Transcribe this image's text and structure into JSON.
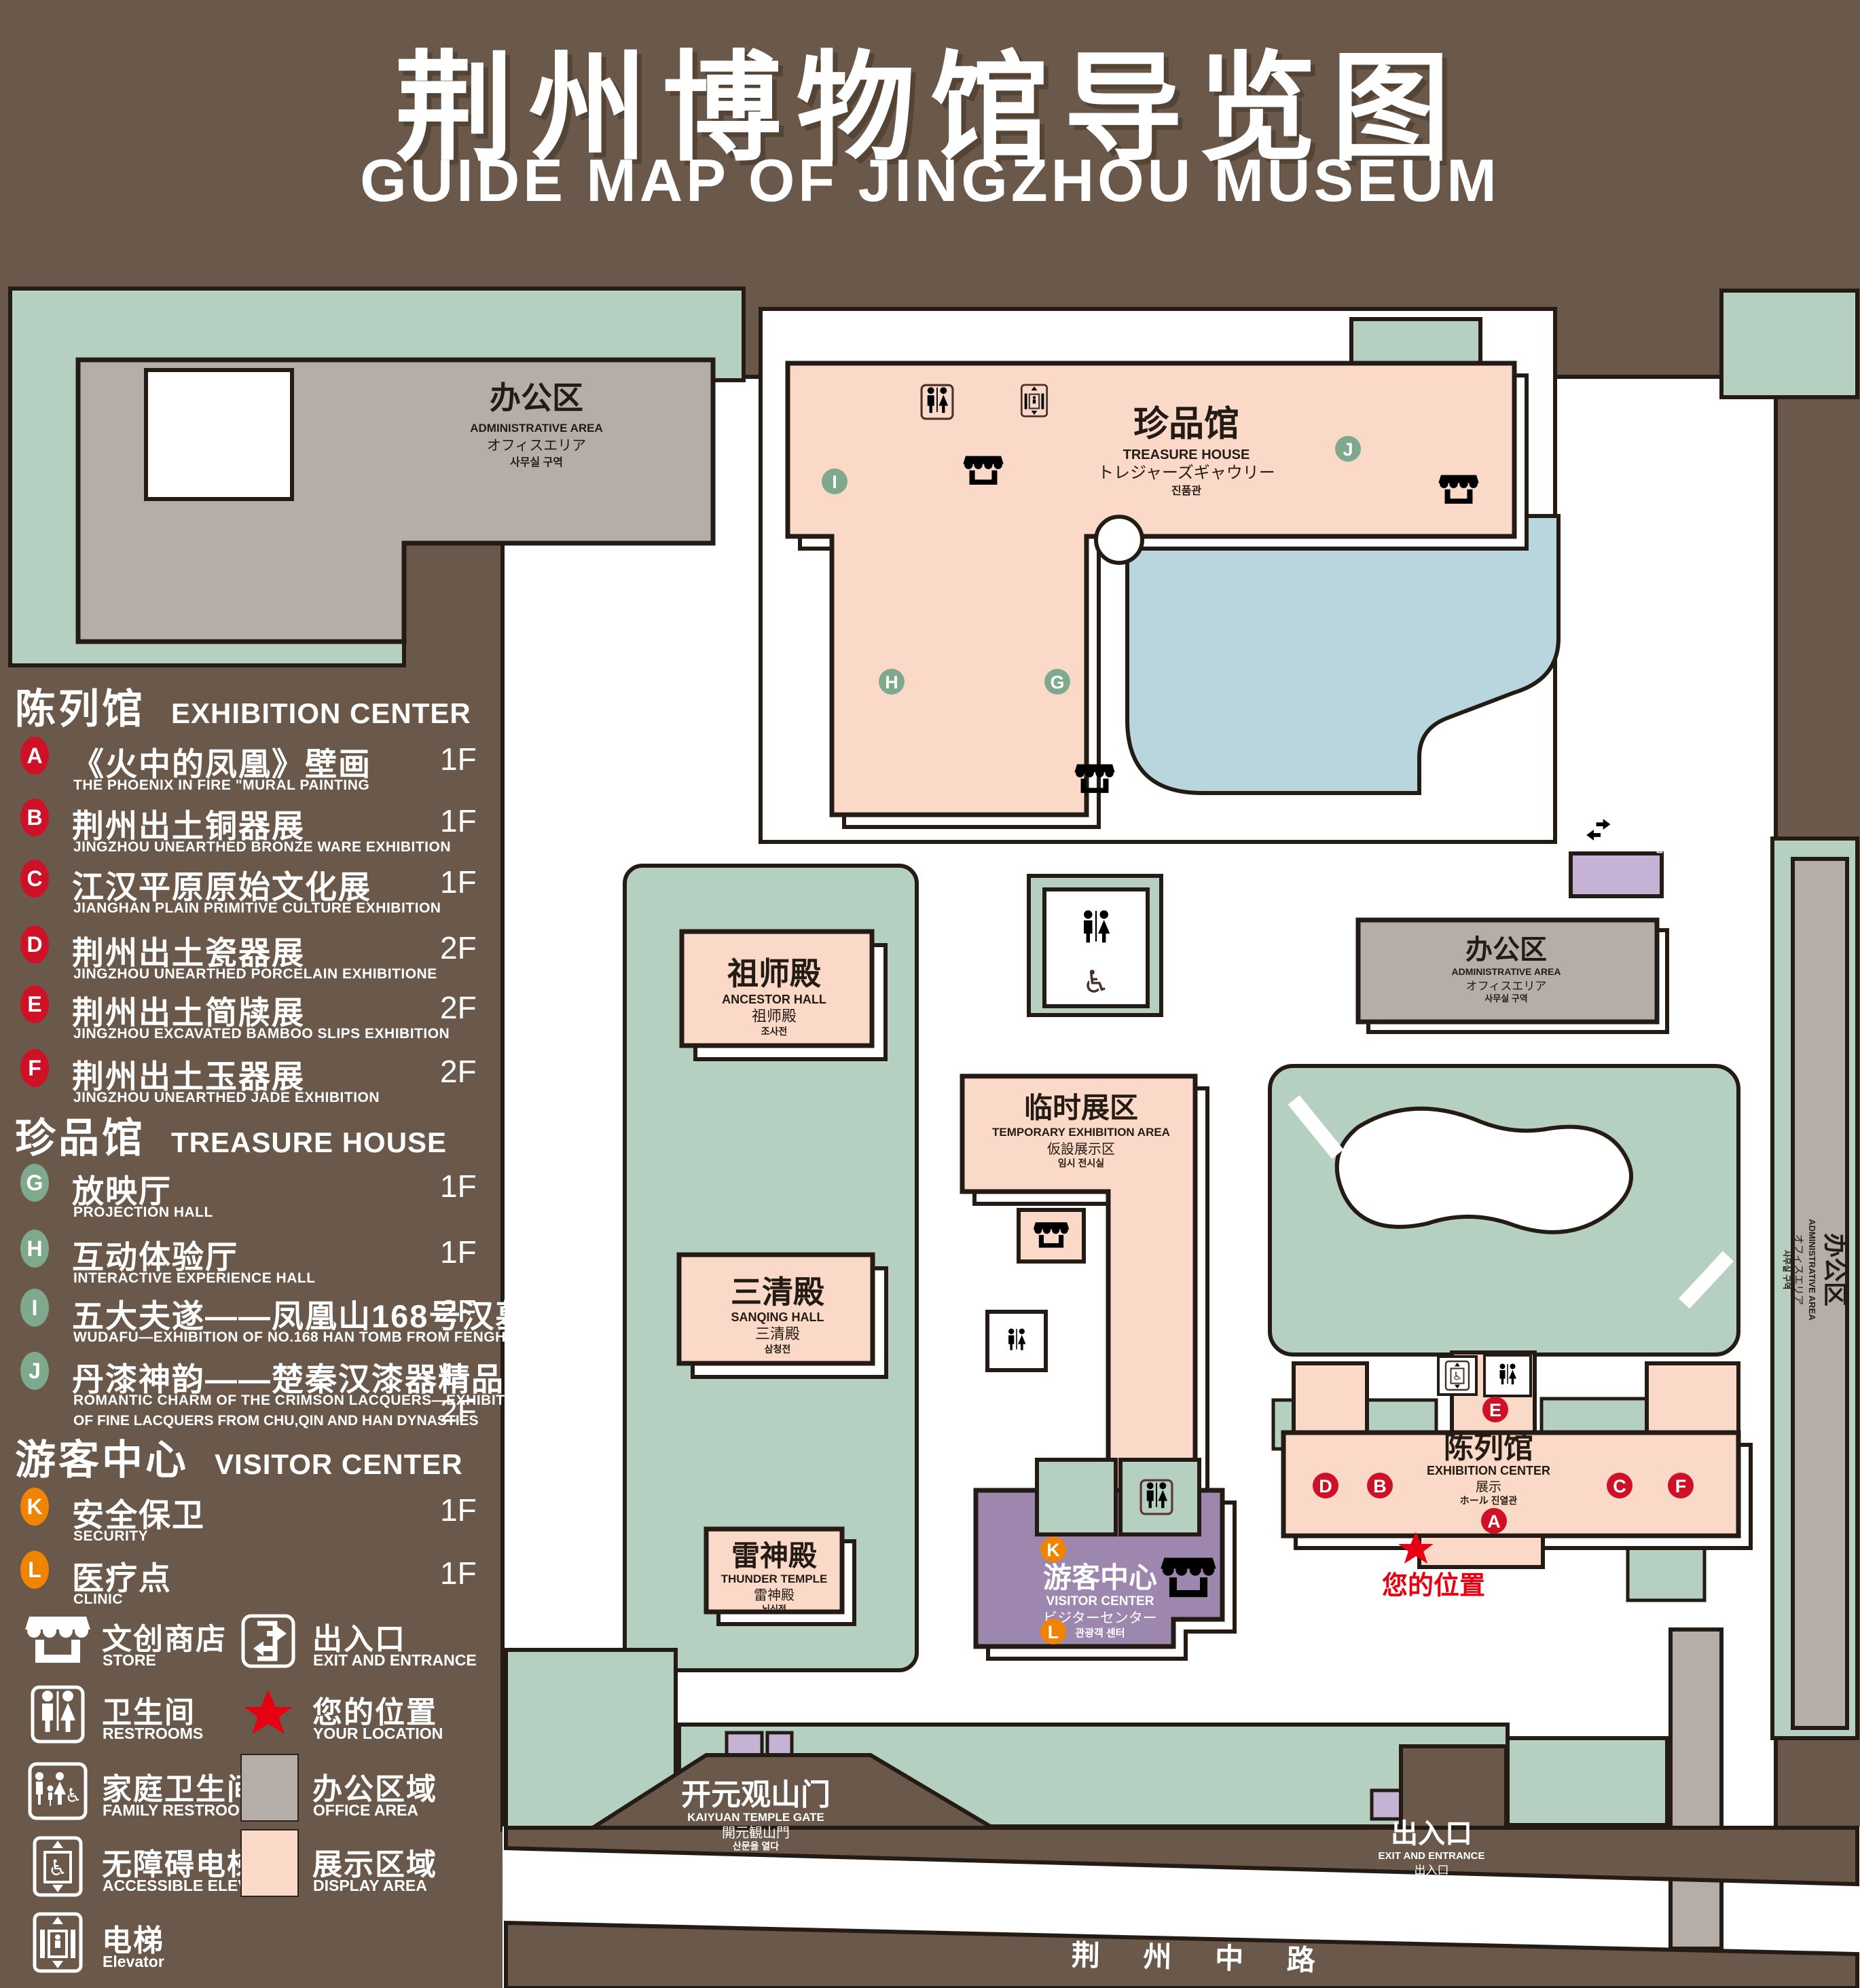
{
  "title": {
    "zh": "荆州博物馆导览图",
    "en": "GUIDE MAP OF JINGZHOU MUSEUM"
  },
  "sections": [
    {
      "zh": "陈列馆",
      "en": "EXHIBITION CENTER"
    },
    {
      "zh": "珍品馆",
      "en": "TREASURE HOUSE"
    },
    {
      "zh": "游客中心",
      "en": "VISITOR CENTER"
    }
  ],
  "spots": [
    {
      "letter": "A",
      "zh": "《火中的凤凰》壁画",
      "en": "THE PHOENIX IN FIRE \"MURAL PAINTING",
      "floor": "1F"
    },
    {
      "letter": "B",
      "zh": "荆州出土铜器展",
      "en": "JINGZHOU UNEARTHED BRONZE WARE EXHIBITION",
      "floor": "1F"
    },
    {
      "letter": "C",
      "zh": "江汉平原原始文化展",
      "en": "JIANGHAN PLAIN PRIMITIVE CULTURE EXHIBITION",
      "floor": "1F"
    },
    {
      "letter": "D",
      "zh": "荆州出土瓷器展",
      "en": "JINGZHOU UNEARTHED PORCELAIN EXHIBITIONE",
      "floor": "2F"
    },
    {
      "letter": "E",
      "zh": "荆州出土简牍展",
      "en": "JINGZHOU EXCAVATED BAMBOO SLIPS EXHIBITION",
      "floor": "2F"
    },
    {
      "letter": "F",
      "zh": "荆州出土玉器展",
      "en": "JINGZHOU UNEARTHED JADE EXHIBITION",
      "floor": "2F"
    },
    {
      "letter": "G",
      "zh": "放映厅",
      "en": "PROJECTION HALL",
      "floor": "1F"
    },
    {
      "letter": "H",
      "zh": "互动体验厅",
      "en": "INTERACTIVE EXPERIENCE HALL",
      "floor": "1F"
    },
    {
      "letter": "I",
      "zh": "五大夫遂——凤凰山168号汉墓展",
      "en": "WUDAFU—EXHIBITION OF NO.168 HAN TOMB FROM FENGHUANGSHAN",
      "floor": "2F"
    },
    {
      "letter": "J",
      "zh": "丹漆神韵——楚秦汉漆器精品展",
      "en": "ROMANTIC CHARM OF THE CRIMSON LACQUERS—EXHIBITIONS",
      "en2": "OF FINE LACQUERS FROM CHU,QIN AND HAN DYNASTIES",
      "floor": "1-2F"
    },
    {
      "letter": "K",
      "zh": "安全保卫",
      "en": "SECURITY",
      "floor": "1F"
    },
    {
      "letter": "L",
      "zh": "医疗点",
      "en": "CLINIC",
      "floor": "1F"
    }
  ],
  "legend": [
    {
      "icon": "store-icon",
      "zh": "文创商店",
      "en": "STORE"
    },
    {
      "icon": "restrooms-icon",
      "zh": "卫生间",
      "en": "RESTROOMS"
    },
    {
      "icon": "family-restrooms-icon",
      "zh": "家庭卫生间",
      "en": "FAMILY RESTROOMS"
    },
    {
      "icon": "accessible-elevator-icon",
      "zh": "无障碍电梯",
      "en": "ACCESSIBLE ELEVATOR"
    },
    {
      "icon": "elevator-icon",
      "zh": "电梯",
      "en": "Elevator"
    },
    {
      "icon": "exit-icon",
      "zh": "出入口",
      "en": "EXIT AND ENTRANCE"
    },
    {
      "icon": "your-location-icon",
      "zh": "您的位置",
      "en": "YOUR LOCATION"
    },
    {
      "icon": "office-area-swatch",
      "zh": "办公区域",
      "en": "OFFICE AREA"
    },
    {
      "icon": "display-area-swatch",
      "zh": "展示区域",
      "en": "DISPLAY AREA"
    }
  ],
  "map": {
    "admin": {
      "zh": "办公区",
      "en": "ADMINISTRATIVE AREA",
      "jp": "オフィスエリア",
      "kr": "사무실 구역"
    },
    "treasure_house": {
      "zh": "珍品馆",
      "en": "TREASURE HOUSE",
      "jp": "トレジャーズギャウリー",
      "kr": "진품관"
    },
    "ancestor_hall": {
      "zh": "祖师殿",
      "en": "ANCESTOR HALL",
      "jp": "祖师殿",
      "kr": "조사전"
    },
    "temporary_area": {
      "zh": "临时展区",
      "en": "TEMPORARY EXHIBITION AREA",
      "jp": "仮設展示区",
      "kr": "임시 전시실"
    },
    "sanqing_hall": {
      "zh": "三清殿",
      "en": "SANQING HALL",
      "jp": "三清殿",
      "kr": "삼청전"
    },
    "thunder_temple": {
      "zh": "雷神殿",
      "en": "THUNDER TEMPLE",
      "jp": "雷神殿",
      "kr": "뇌신전"
    },
    "visitor_center": {
      "zh": "游客中心",
      "en": "VISITOR CENTER",
      "jp": "ビジターセンター",
      "kr": "관광객 센터"
    },
    "exhibition_center": {
      "zh": "陈列馆",
      "en": "EXHIBITION CENTER",
      "jp": "展示",
      "kr": "ホール 진열관"
    },
    "kaiyuan_gate": {
      "zh": "开元观山门",
      "en": "KAIYUAN TEMPLE GATE",
      "jp": "開元観山門",
      "kr": "산문을 열다"
    },
    "exit": {
      "zh": "出入口",
      "en": "EXIT AND ENTRANCE",
      "jp": "出入口",
      "kr": "출입구"
    },
    "your_location": {
      "zh": "您的位置"
    },
    "road": {
      "zh": "荆 州 中 路"
    }
  },
  "colors": {
    "background_brown": "#6a594a",
    "campus_white": "#ffffff",
    "green_area": "#b5cfc0",
    "office_gray": "#b5ada7",
    "display_pink": "#fad9c8",
    "visitor_purple": "#9d87ae",
    "gate_lavender": "#c6b2d4",
    "water_blue": "#b9d5de",
    "marker_red": "#ce1126",
    "marker_green": "#7ea98c",
    "marker_orange": "#f08300",
    "location_red": "#e60012",
    "outline_dark": "#241c14"
  }
}
